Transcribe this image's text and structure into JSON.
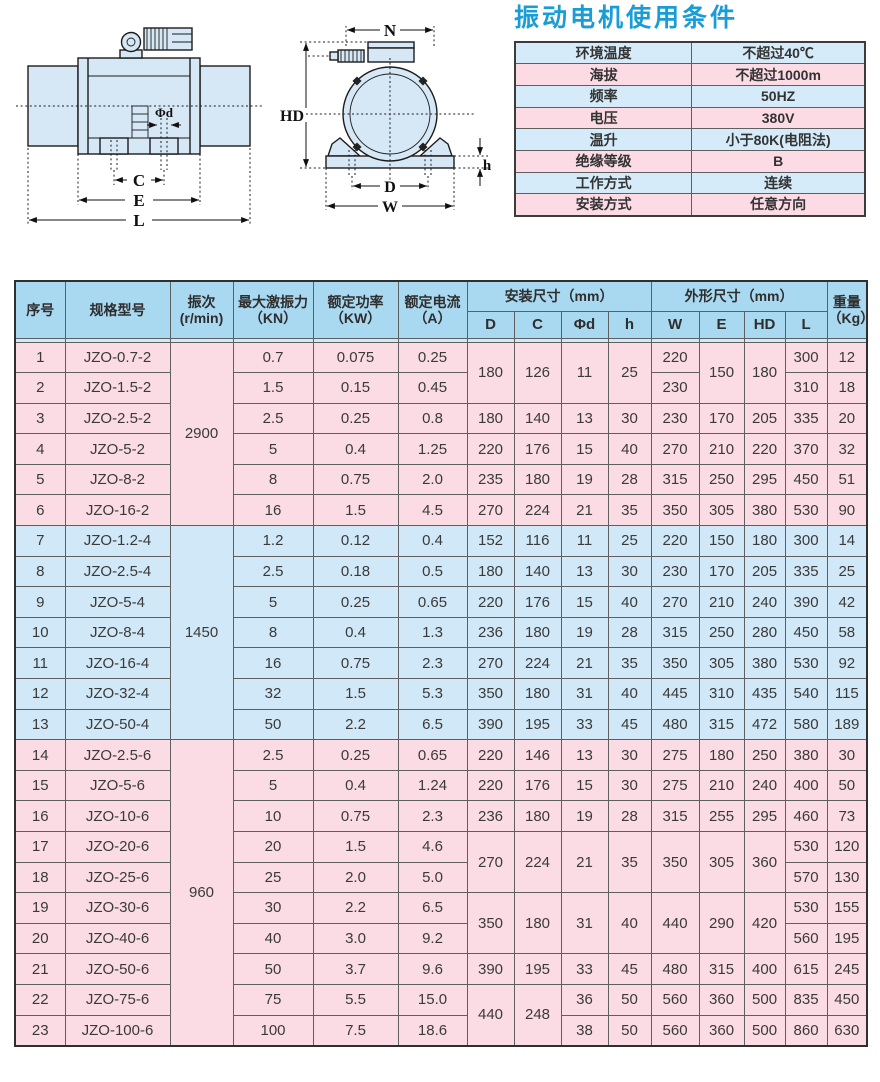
{
  "theme": {
    "accent": "#1a9cd7",
    "header_blue": "#a9d8f1",
    "row_pink": "#fbdce4",
    "row_blue": "#d0e8f7",
    "cond_blue": "#d5ebf9",
    "cond_pink": "#fcdbe5",
    "drawing_fill": "#d6e7f5"
  },
  "conditions": {
    "title": "振动电机使用条件",
    "rows": [
      {
        "label": "环境温度",
        "value": "不超过40℃"
      },
      {
        "label": "海拔",
        "value": "不超过1000m"
      },
      {
        "label": "频率",
        "value": "50HZ"
      },
      {
        "label": "电压",
        "value": "380V"
      },
      {
        "label": "温升",
        "value": "小于80K(电阻法)"
      },
      {
        "label": "绝缘等级",
        "value": "B"
      },
      {
        "label": "工作方式",
        "value": "连续"
      },
      {
        "label": "安装方式",
        "value": "任意方向"
      }
    ]
  },
  "drawings": {
    "side_view": {
      "dim_phid": "Φd",
      "dim_c": "C",
      "dim_e": "E",
      "dim_l": "L"
    },
    "front_view": {
      "dim_n": "N",
      "dim_hd": "HD",
      "dim_h": "h",
      "dim_d": "D",
      "dim_w": "W"
    }
  },
  "spec_table": {
    "headers": {
      "seq": "序号",
      "model": "规格型号",
      "speed_line1": "振次",
      "speed_line2": "(r/min)",
      "force_line1": "最大激振力",
      "force_line2": "（KN）",
      "power_line1": "额定功率",
      "power_line2": "（KW）",
      "current_line1": "额定电流",
      "current_line2": "（A）",
      "mount_group": "安装尺寸（mm）",
      "outline_group": "外形尺寸（mm）",
      "mount_cols": [
        "D",
        "C",
        "Φd",
        "h"
      ],
      "outline_cols": [
        "W",
        "E",
        "HD",
        "L"
      ],
      "weight_line1": "重量",
      "weight_line2": "（Kg）"
    },
    "groups": [
      {
        "color": "pink",
        "rows": [
          [
            "1",
            "JZO-0.7-2",
            {
              "t": "2900",
              "rs": 6
            },
            "0.7",
            "0.075",
            "0.25",
            {
              "t": "180",
              "rs": 2
            },
            {
              "t": "126",
              "rs": 2
            },
            {
              "t": "11",
              "rs": 2
            },
            {
              "t": "25",
              "rs": 2
            },
            "220",
            {
              "t": "150",
              "rs": 2
            },
            {
              "t": "180",
              "rs": 2
            },
            "300",
            "12"
          ],
          [
            "2",
            "JZO-1.5-2",
            "1.5",
            "0.15",
            "0.45",
            "230",
            "310",
            "18"
          ],
          [
            "3",
            "JZO-2.5-2",
            "2.5",
            "0.25",
            "0.8",
            "180",
            "140",
            "13",
            "30",
            "230",
            "170",
            "205",
            "335",
            "20"
          ],
          [
            "4",
            "JZO-5-2",
            "5",
            "0.4",
            "1.25",
            "220",
            "176",
            "15",
            "40",
            "270",
            "210",
            "220",
            "370",
            "32"
          ],
          [
            "5",
            "JZO-8-2",
            "8",
            "0.75",
            "2.0",
            "235",
            "180",
            "19",
            "28",
            "315",
            "250",
            "295",
            "450",
            "51"
          ],
          [
            "6",
            "JZO-16-2",
            "16",
            "1.5",
            "4.5",
            "270",
            "224",
            "21",
            "35",
            "350",
            "305",
            "380",
            "530",
            "90"
          ]
        ]
      },
      {
        "color": "blue",
        "rows": [
          [
            "7",
            "JZO-1.2-4",
            {
              "t": "1450",
              "rs": 7
            },
            "1.2",
            "0.12",
            "0.4",
            "152",
            "116",
            "11",
            "25",
            "220",
            "150",
            "180",
            "300",
            "14"
          ],
          [
            "8",
            "JZO-2.5-4",
            "2.5",
            "0.18",
            "0.5",
            "180",
            "140",
            "13",
            "30",
            "230",
            "170",
            "205",
            "335",
            "25"
          ],
          [
            "9",
            "JZO-5-4",
            "5",
            "0.25",
            "0.65",
            "220",
            "176",
            "15",
            "40",
            "270",
            "210",
            "240",
            "390",
            "42"
          ],
          [
            "10",
            "JZO-8-4",
            "8",
            "0.4",
            "1.3",
            "236",
            "180",
            "19",
            "28",
            "315",
            "250",
            "280",
            "450",
            "58"
          ],
          [
            "11",
            "JZO-16-4",
            "16",
            "0.75",
            "2.3",
            "270",
            "224",
            "21",
            "35",
            "350",
            "305",
            "380",
            "530",
            "92"
          ],
          [
            "12",
            "JZO-32-4",
            "32",
            "1.5",
            "5.3",
            "350",
            "180",
            "31",
            "40",
            "445",
            "310",
            "435",
            "540",
            "115"
          ],
          [
            "13",
            "JZO-50-4",
            "50",
            "2.2",
            "6.5",
            "390",
            "195",
            "33",
            "45",
            "480",
            "315",
            "472",
            "580",
            "189"
          ]
        ]
      },
      {
        "color": "pink",
        "rows": [
          [
            "14",
            "JZO-2.5-6",
            {
              "t": "960",
              "rs": 10
            },
            "2.5",
            "0.25",
            "0.65",
            "220",
            "146",
            "13",
            "30",
            "275",
            "180",
            "250",
            "380",
            "30"
          ],
          [
            "15",
            "JZO-5-6",
            "5",
            "0.4",
            "1.24",
            "220",
            "176",
            "15",
            "30",
            "275",
            "210",
            "240",
            "400",
            "50"
          ],
          [
            "16",
            "JZO-10-6",
            "10",
            "0.75",
            "2.3",
            "236",
            "180",
            "19",
            "28",
            "315",
            "255",
            "295",
            "460",
            "73"
          ],
          [
            "17",
            "JZO-20-6",
            "20",
            "1.5",
            "4.6",
            {
              "t": "270",
              "rs": 2
            },
            {
              "t": "224",
              "rs": 2
            },
            {
              "t": "21",
              "rs": 2
            },
            {
              "t": "35",
              "rs": 2
            },
            {
              "t": "350",
              "rs": 2
            },
            {
              "t": "305",
              "rs": 2
            },
            {
              "t": "360",
              "rs": 2
            },
            "530",
            "120"
          ],
          [
            "18",
            "JZO-25-6",
            "25",
            "2.0",
            "5.0",
            "570",
            "130"
          ],
          [
            "19",
            "JZO-30-6",
            "30",
            "2.2",
            "6.5",
            {
              "t": "350",
              "rs": 2
            },
            {
              "t": "180",
              "rs": 2
            },
            {
              "t": "31",
              "rs": 2
            },
            {
              "t": "40",
              "rs": 2
            },
            {
              "t": "440",
              "rs": 2
            },
            {
              "t": "290",
              "rs": 2
            },
            {
              "t": "420",
              "rs": 2
            },
            "530",
            "155"
          ],
          [
            "20",
            "JZO-40-6",
            "40",
            "3.0",
            "9.2",
            "560",
            "195"
          ],
          [
            "21",
            "JZO-50-6",
            "50",
            "3.7",
            "9.6",
            "390",
            "195",
            "33",
            "45",
            "480",
            "315",
            "400",
            "615",
            "245"
          ],
          [
            "22",
            "JZO-75-6",
            "75",
            "5.5",
            "15.0",
            {
              "t": "440",
              "rs": 2
            },
            {
              "t": "248",
              "rs": 2
            },
            "36",
            "50",
            "560",
            "360",
            "500",
            "835",
            "450"
          ],
          [
            "23",
            "JZO-100-6",
            "100",
            "7.5",
            "18.6",
            "38",
            "50",
            "560",
            "360",
            "500",
            "860",
            "630"
          ]
        ]
      }
    ]
  }
}
